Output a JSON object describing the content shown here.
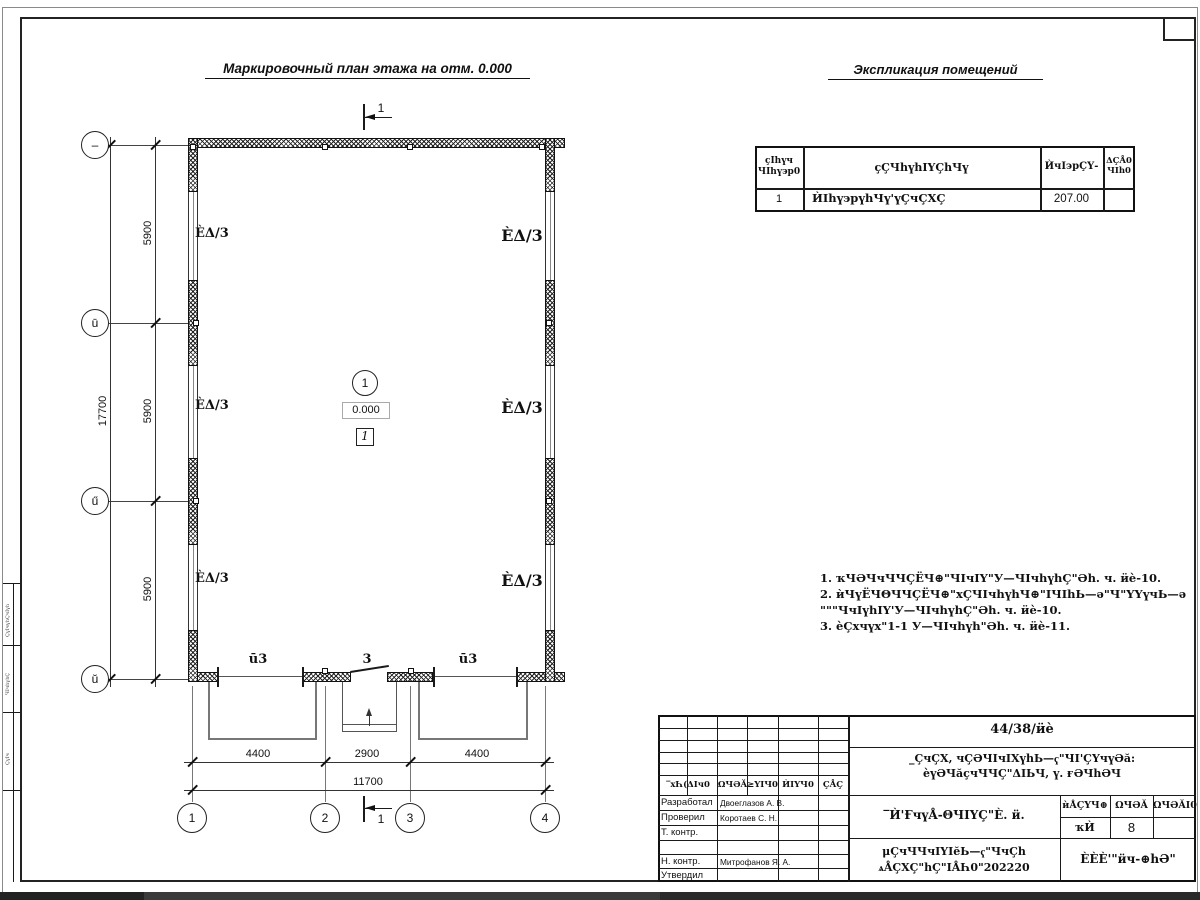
{
  "plan": {
    "title": "Маркировочный план этажа на отм. 0.000",
    "section_label": "1",
    "room": {
      "number": "1",
      "elevation": "0.000",
      "type_mark": "1"
    },
    "window_labels": [
      "ÈΔ/3",
      "ÈΔ/3",
      "ÈΔ/3",
      "ÈΔ/3",
      "ÈΔ/3",
      "ÈΔ/3"
    ],
    "gate_labels": [
      "ū3",
      "3",
      "ū3"
    ],
    "axes": {
      "cols": [
        "1",
        "2",
        "3",
        "4"
      ],
      "rows": [
        "–",
        "ū",
        "ű",
        "ŭ"
      ]
    },
    "dims": {
      "col_segments": [
        "4400",
        "2900",
        "4400"
      ],
      "col_total": "11700",
      "row_segments": [
        "5900",
        "5900",
        "5900"
      ],
      "row_total": "17700"
    }
  },
  "explication": {
    "title": "Экспликация помещений",
    "h1a": "ҫIһүч",
    "h1b": "ЧIһү϶р0",
    "h2": "ҫҪЧһүhIΥҪhЧү",
    "h3": "ЍчI϶рҪΥ-",
    "h4a": "ΔҪÅ0",
    "h4b": "ЧIһ0",
    "row": {
      "num": "1",
      "name": "ЍIһү϶рүhЧү'үҪчҪΧҪ",
      "area": "207.00",
      "cat": ""
    }
  },
  "notes": [
    "1. ҡЧӘЧчЧЧҪЁЧ⊕\"ЧIчIΥ\"У—ЧIчhүhҪ\"Әh. ч. ӥè-10.",
    "2. ѝЧүЁЧΘЧЧҪЁЧ⊕\"хҪЧIчhүhЧ⊕\"IЧIhЬ—ә\"Ч\"ΥΥүчЬ—ә",
    "\"\"\"ЧчIүhIΥ'У—ЧIчhүhҪ\"Әh. ч. ӥè-10.",
    "3. ѐҪхчүх\"1-1 У—ЧIчhүh\"Әh. ч. ӥè-11."
  ],
  "titleblock": {
    "doc_number": "44/38/ӥè",
    "project_line1": "_ҪчҪΧ, чҪӘЧIчIΧүhЬ—ҁ\"ЧI'ҪΥчүӘă:",
    "project_line2": "ѐүӘЧăҫчЧЧҪ\"ΔIЬЧ, ү. ғӘЧhӘЧ",
    "drawing_title": "‾Ѝ'ҒчүÅ-ΘЧIΥҪ\"È. ӥ.",
    "header_cells": [
      "‾хҺ(ΔIч0",
      "ΩЧӘĂ",
      "≥ΥΙЧ0",
      "ЍIΥЧ0",
      "ҪÅҪ"
    ],
    "rows": [
      {
        "role": "Разработал",
        "name": "Двоеглазов А. В."
      },
      {
        "role": "Проверил",
        "name": "Коротаев С. Н."
      },
      {
        "role": "Т. контр.",
        "name": ""
      },
      {
        "role": "Н. контр.",
        "name": "Митрофанов Я. А."
      },
      {
        "role": "Утвердил",
        "name": ""
      }
    ],
    "stage_header": "ѝÅҪΥЧ⊕",
    "sheet_header": "ΩЧӘĂ",
    "sheets_header": "ΩЧӘĂI0",
    "stage_value": "ҡЍ",
    "sheet_value": "8",
    "sheets_value": "",
    "org_line1": "μҪчЧЧчIΥIĕЬ—ҁ\"ЧчҪh",
    "org_line2": "ѧÅҪΧҪ\"hҪ\"IÅҺ0\"202220",
    "company": "ÈÈÈ'\"ӥч-⊕hӘ\""
  },
  "strip": {
    "cell1": "ҪүΙчүһҪчΙүһ",
    "cell2": "ЧΙчһүһҪ",
    "cell3": "ҪүΙч"
  }
}
